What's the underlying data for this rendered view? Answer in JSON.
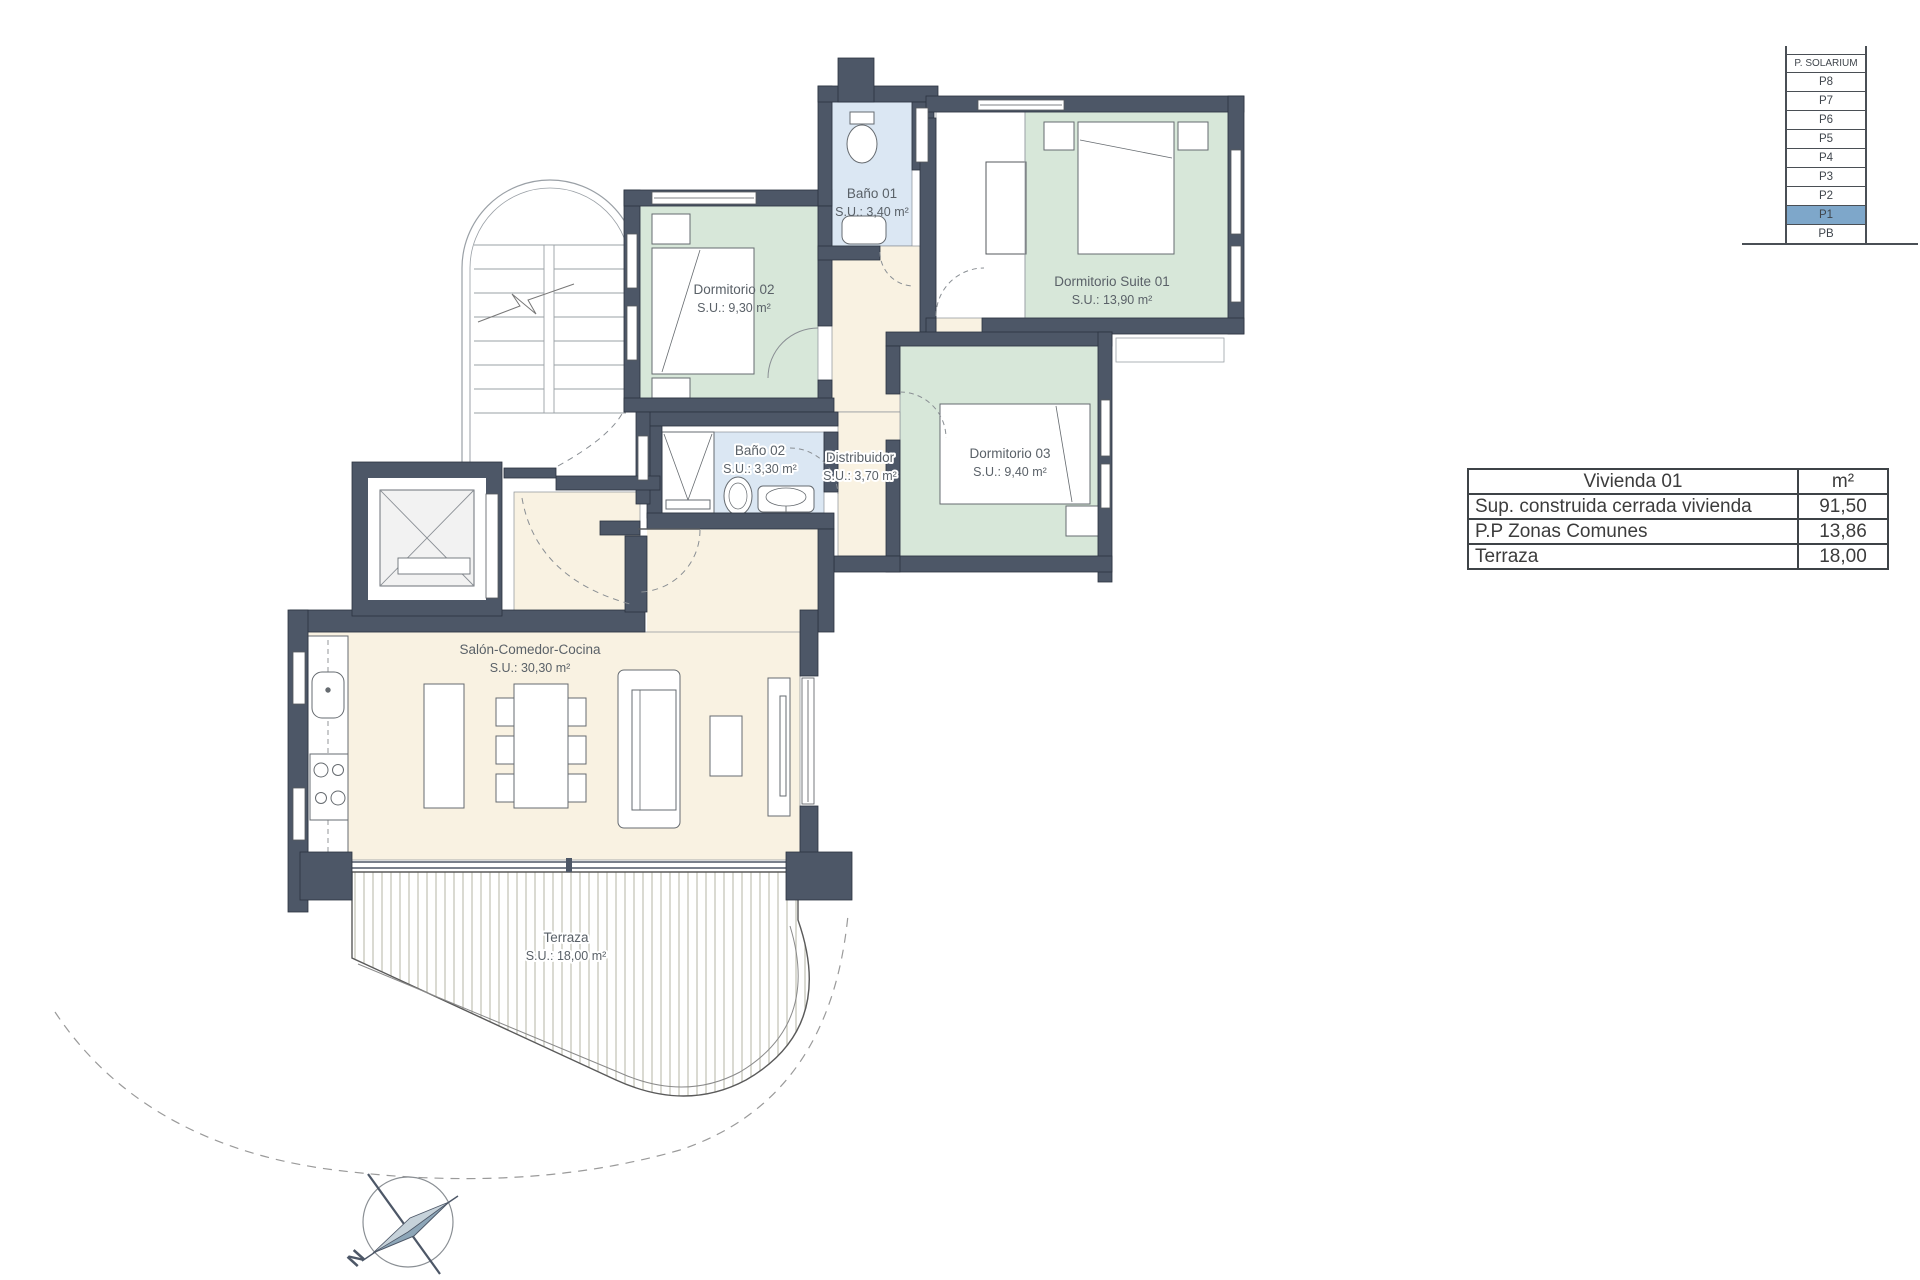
{
  "plan": {
    "rooms": [
      {
        "name": "Dormitorio 02",
        "area": "S.U.: 9,30 m²"
      },
      {
        "name": "Baño 01",
        "area": "S.U.: 3,40 m²"
      },
      {
        "name": "Dormitorio Suite 01",
        "area": "S.U.: 13,90 m²"
      },
      {
        "name": "Baño 02",
        "area": "S.U.: 3,30 m²"
      },
      {
        "name": "Distribuidor",
        "area": "S.U.: 3,70 m²"
      },
      {
        "name": "Dormitorio 03",
        "area": "S.U.: 9,40 m²"
      },
      {
        "name": "Salón-Comedor-Cocina",
        "area": "S.U.: 30,30 m²"
      },
      {
        "name": "Terraza",
        "area": "S.U.: 18,00 m²"
      }
    ],
    "compass_label": "N"
  },
  "floor_selector": {
    "rows": [
      {
        "label": "P. SOLARIUM",
        "selected": false
      },
      {
        "label": "P8",
        "selected": false
      },
      {
        "label": "P7",
        "selected": false
      },
      {
        "label": "P6",
        "selected": false
      },
      {
        "label": "P5",
        "selected": false
      },
      {
        "label": "P4",
        "selected": false
      },
      {
        "label": "P3",
        "selected": false
      },
      {
        "label": "P2",
        "selected": false
      },
      {
        "label": "P1",
        "selected": true
      },
      {
        "label": "PB",
        "selected": false
      }
    ]
  },
  "area_table": {
    "title": "Vivienda 01",
    "unit": "m²",
    "rows": [
      {
        "label": "Sup. construida cerrada vivienda",
        "value": "91,50"
      },
      {
        "label": "P.P Zonas Comunes",
        "value": "13,86"
      },
      {
        "label": "Terraza",
        "value": "18,00"
      }
    ]
  },
  "colors": {
    "wall": "#4d5767",
    "bedroom_fill": "#d7e7d9",
    "bathroom_fill": "#dbe7f3",
    "living_fill": "#f9f2e2",
    "selected_floor": "#7ea7ca"
  }
}
